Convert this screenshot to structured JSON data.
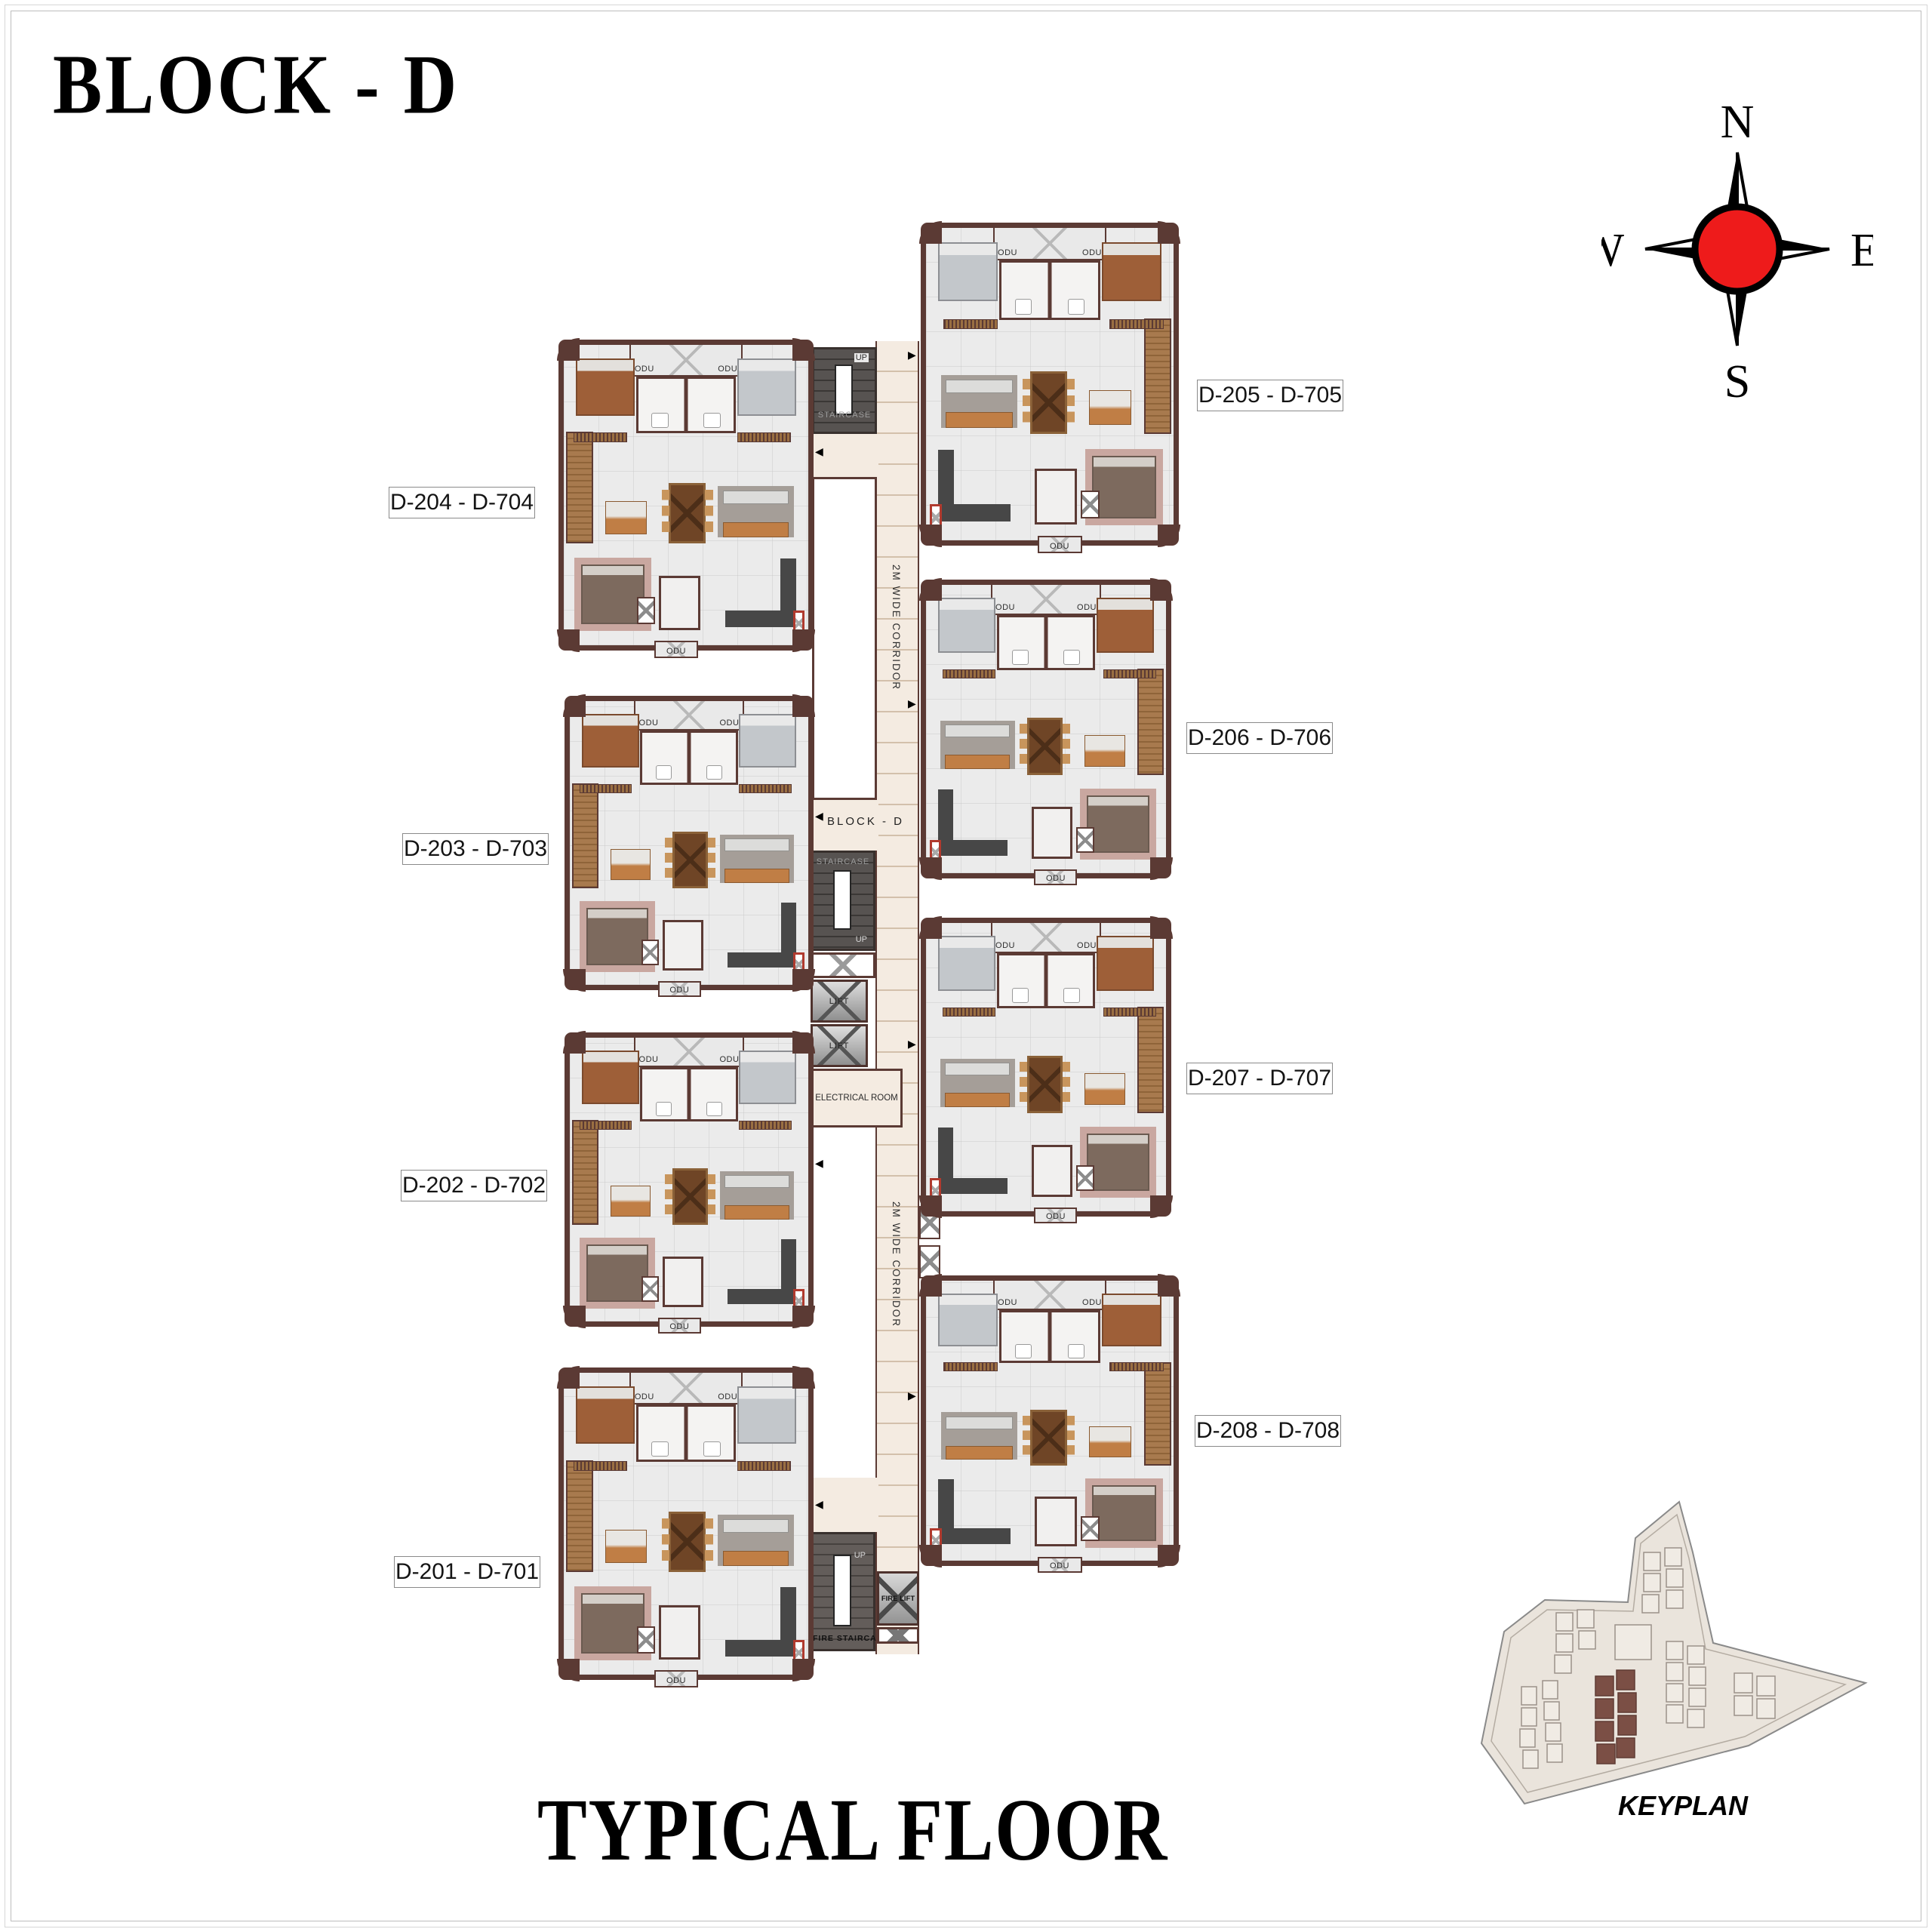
{
  "page": {
    "title": "BLOCK - D",
    "subtitle": "TYPICAL FLOOR"
  },
  "compass": {
    "n": "N",
    "e": "E",
    "s": "S",
    "w": "W"
  },
  "units": [
    {
      "id": "D-204",
      "label": "D-204 - D-704"
    },
    {
      "id": "D-203",
      "label": "D-203 - D-703"
    },
    {
      "id": "D-202",
      "label": "D-202 - D-702"
    },
    {
      "id": "D-201",
      "label": "D-201 - D-701"
    },
    {
      "id": "D-205",
      "label": "D-205 - D-705"
    },
    {
      "id": "D-206",
      "label": "D-206 - D-706"
    },
    {
      "id": "D-207",
      "label": "D-207 - D-707"
    },
    {
      "id": "D-208",
      "label": "D-208 - D-708"
    }
  ],
  "corridor": {
    "width_label_top": "2M WIDE CORRIDOR",
    "width_label_bottom": "2M WIDE CORRIDOR",
    "block_label": "BLOCK - D"
  },
  "core": {
    "staircase": "STAIRCASE",
    "up": "UP",
    "lift": "LIFT",
    "electrical_room": "ELECTRICAL ROOM",
    "fire_lift": "FIRE LIFT",
    "fire_staircase": "FIRE STAIRCASE"
  },
  "labels": {
    "odu": "ODU"
  },
  "keyplan": {
    "title": "KEYPLAN"
  },
  "colors": {
    "wall": "#5b3a34",
    "corridor_floor": "#f4ebe1",
    "tile_floor": "#ebebeb",
    "compass_red": "#ee1b1b",
    "keyplan_highlight": "#7b4f45",
    "stair_dark": "#4a4644",
    "deck_wood": "#a87a4e",
    "fire_shaft_red": "#b03a2e"
  }
}
